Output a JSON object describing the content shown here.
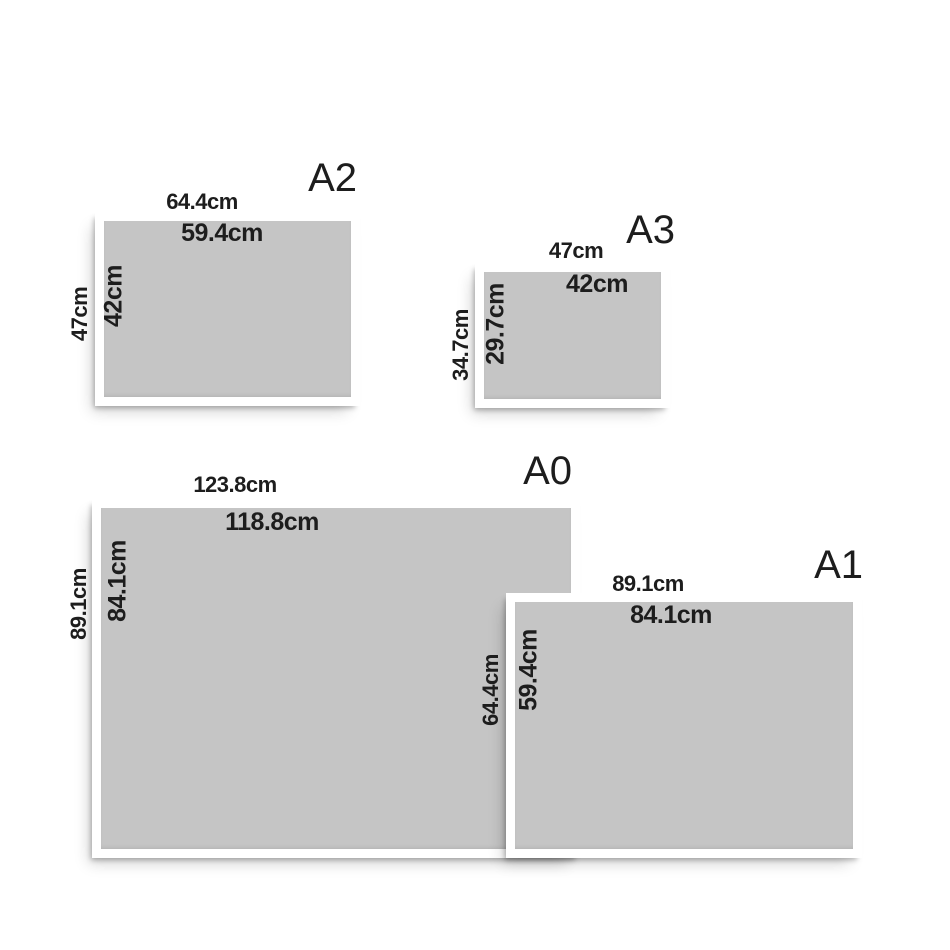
{
  "colors": {
    "background": "#ffffff",
    "frame": "#ffffff",
    "sheet_gray": "#c5c5c5",
    "text": "#1d1d1d"
  },
  "posters": {
    "a2": {
      "title": "A2",
      "outer_width": "64.4cm",
      "inner_width": "59.4cm",
      "outer_height": "47cm",
      "inner_height": "42cm"
    },
    "a3": {
      "title": "A3",
      "outer_width": "47cm",
      "inner_width": "42cm",
      "outer_height": "34.7cm",
      "inner_height": "29.7cm"
    },
    "a0": {
      "title": "A0",
      "outer_width": "123.8cm",
      "inner_width": "118.8cm",
      "outer_height": "89.1cm",
      "inner_height": "84.1cm"
    },
    "a1": {
      "title": "A1",
      "outer_width": "89.1cm",
      "inner_width": "84.1cm",
      "outer_height": "64.4cm",
      "inner_height": "59.4cm"
    }
  }
}
